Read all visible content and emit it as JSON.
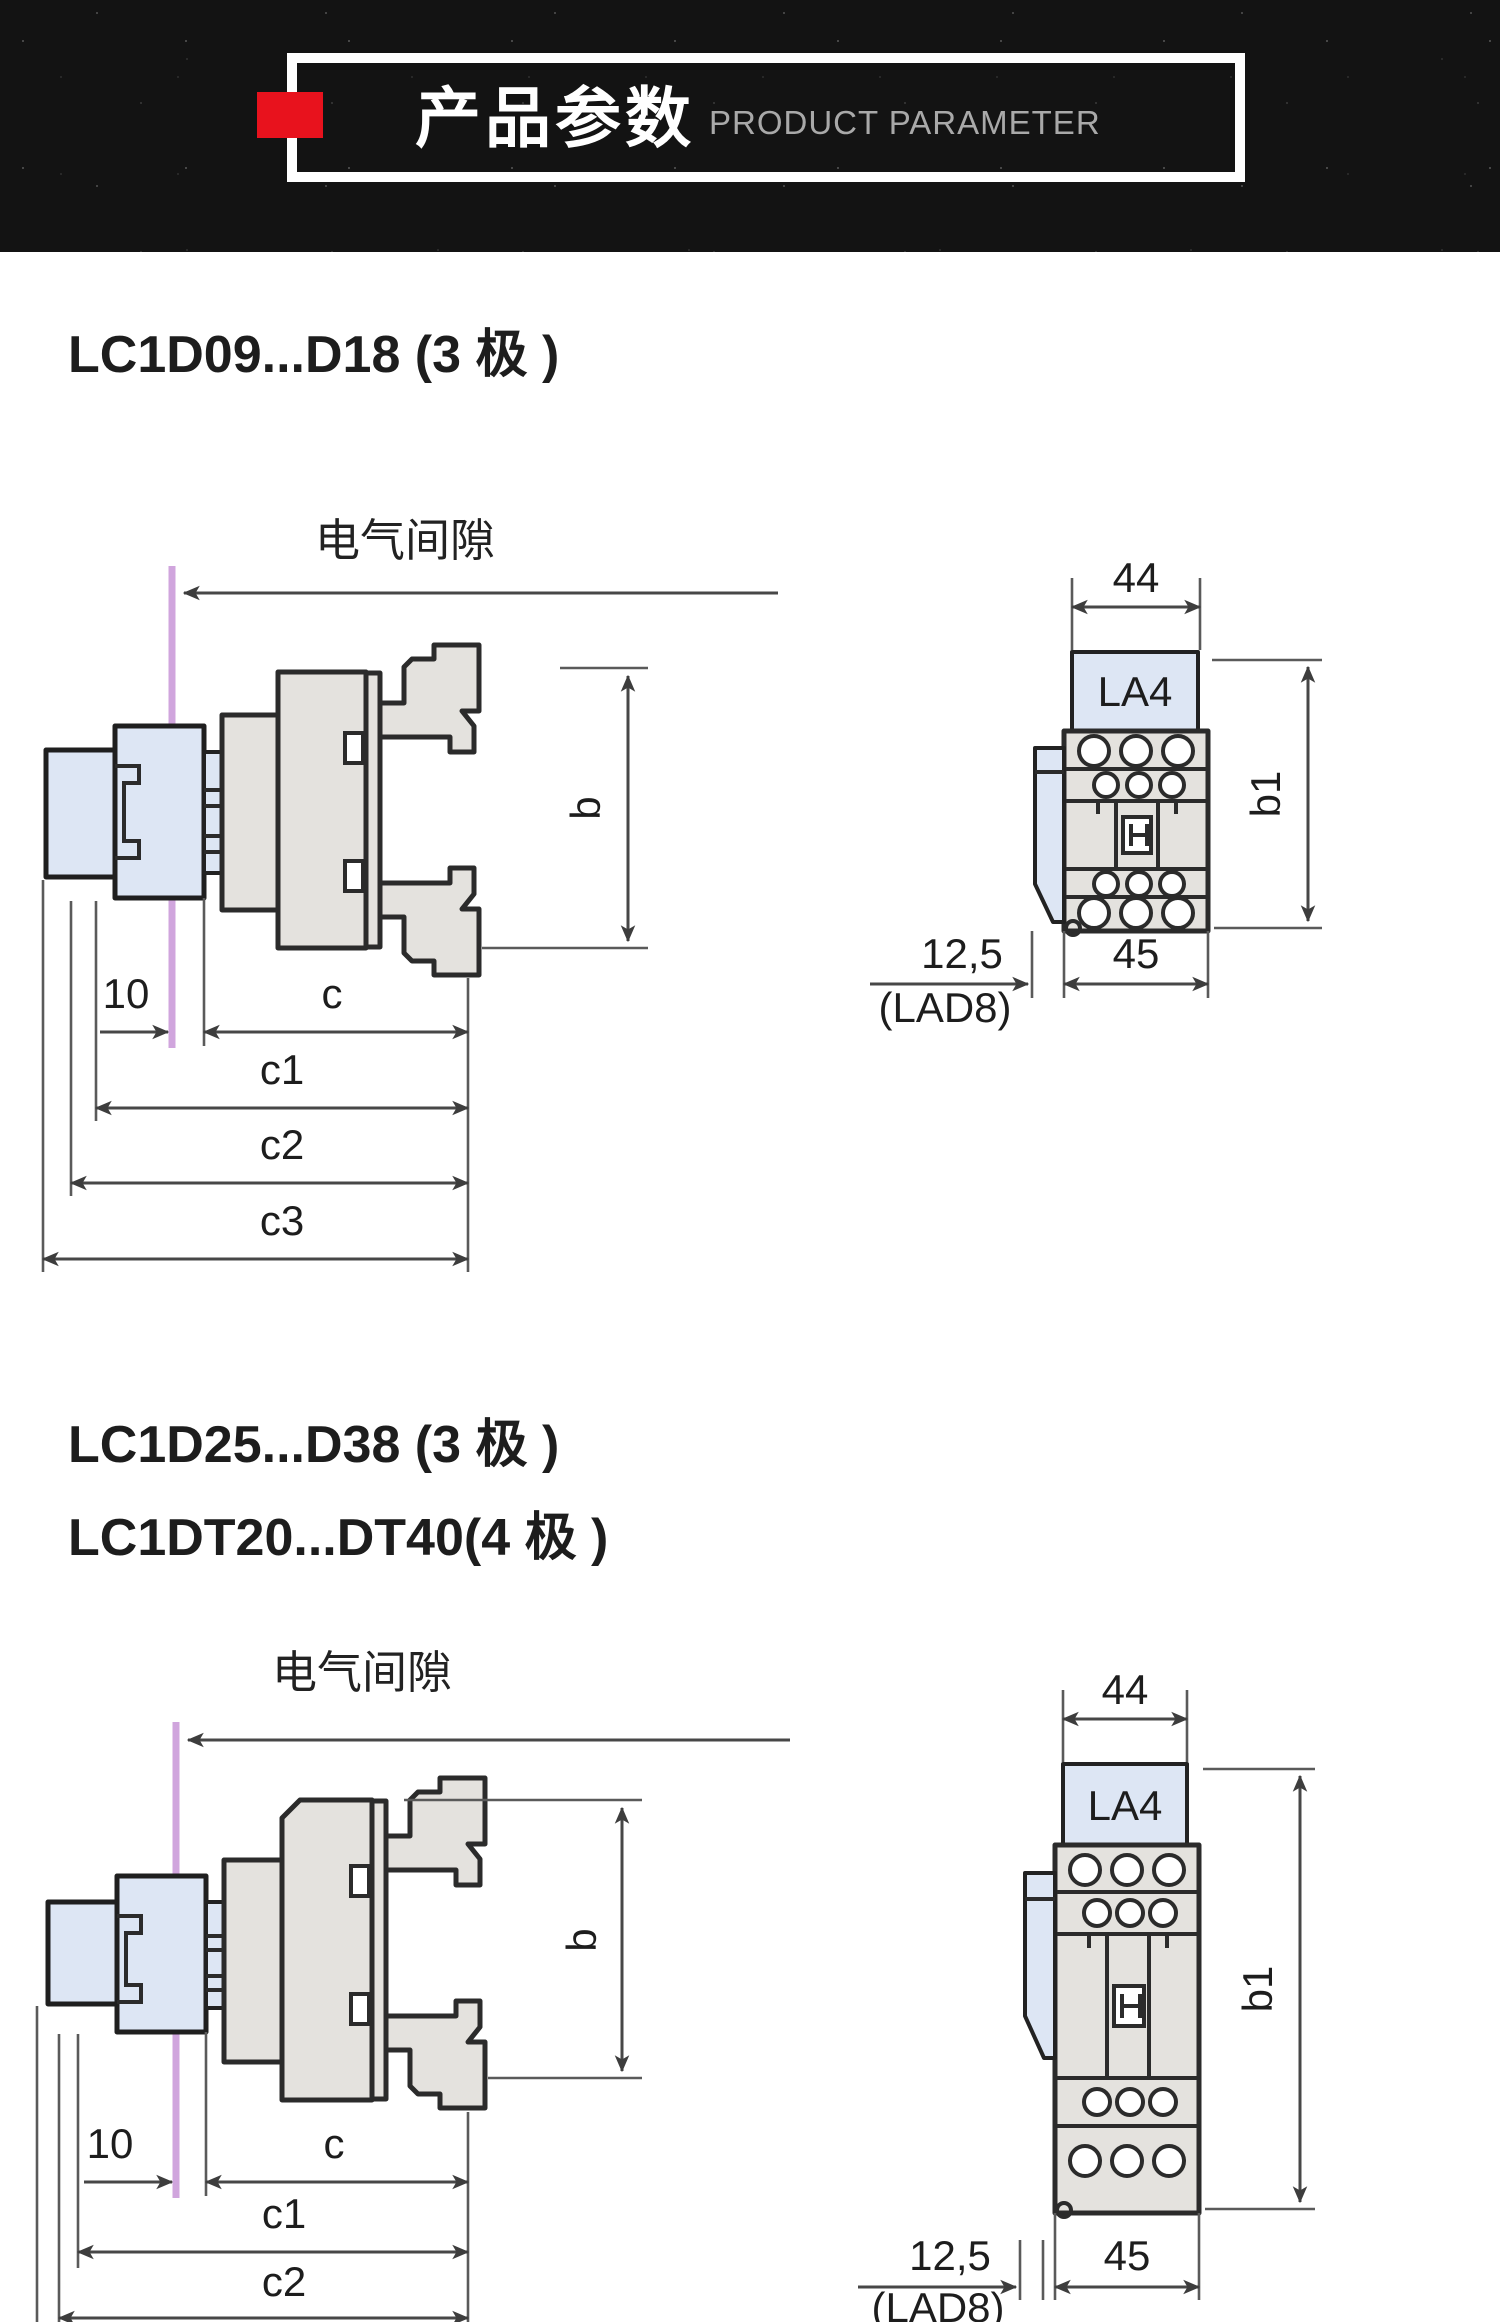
{
  "header": {
    "title_cn": "产品参数",
    "title_en": "PRODUCT PARAMETER",
    "band_color": "#131313",
    "accent_red": "#e8121d"
  },
  "section1": {
    "title": "LC1D09...D18 (3 极 )",
    "side_view": {
      "clearance_label": "电气间隙",
      "dim_b": "b",
      "dim_10": "10",
      "dim_c": "c",
      "dim_c1": "c1",
      "dim_c2": "c2",
      "dim_c3": "c3"
    },
    "front_view": {
      "dim_top_width": "44",
      "module_label": "LA4",
      "dim_height": "b1",
      "dim_offset": "12,5",
      "offset_note": "(LAD8)",
      "dim_base_width": "45"
    }
  },
  "section2": {
    "title_line1": "LC1D25...D38 (3 极 )",
    "title_line2": "LC1DT20...DT40(4 极 )",
    "side_view": {
      "clearance_label": "电气间隙",
      "dim_b": "b",
      "dim_10": "10",
      "dim_c": "c",
      "dim_c1": "c1",
      "dim_c2": "c2"
    },
    "front_view": {
      "dim_top_width": "44",
      "module_label": "LA4",
      "dim_height": "b1",
      "dim_offset": "12,5",
      "offset_note": "(LAD8)",
      "dim_base_width": "45"
    }
  },
  "colors": {
    "outline": "#2b2b2b",
    "dimension_line": "#474747",
    "body_fill": "#e4e2de",
    "accessory_fill": "#dde6f4",
    "reference_line": "#d0a5dd"
  }
}
